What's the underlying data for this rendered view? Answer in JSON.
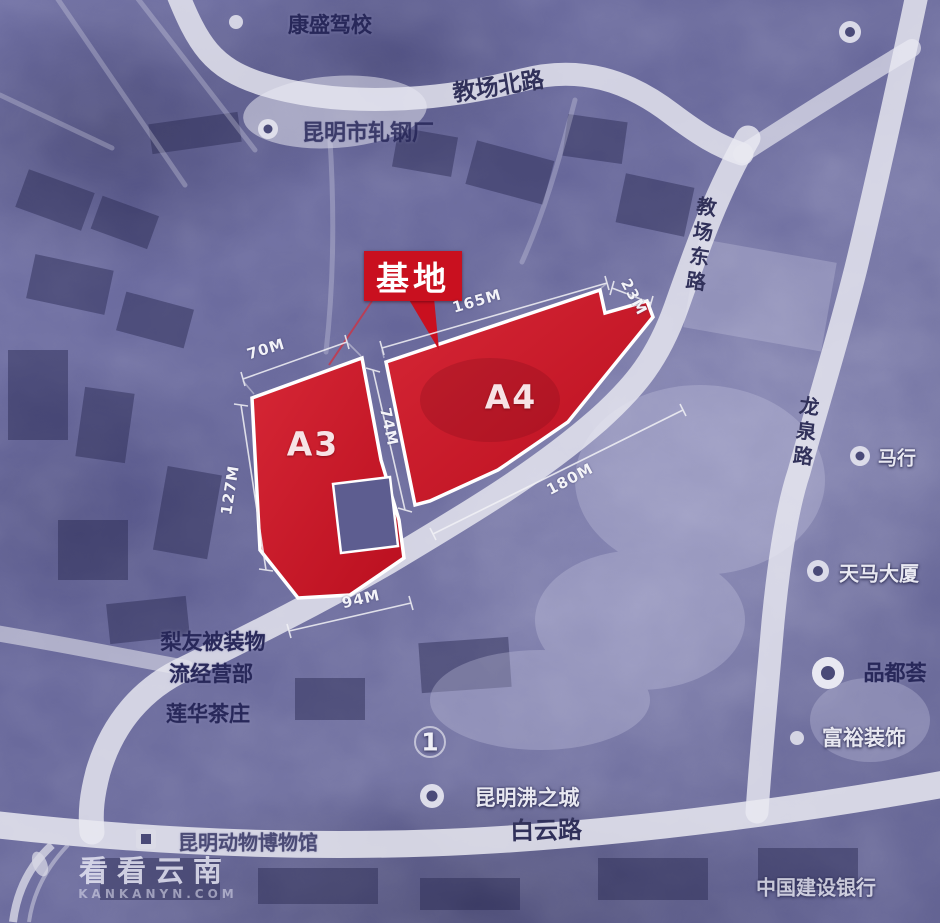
{
  "map": {
    "callout": {
      "label": "基地"
    },
    "parcels": {
      "a3": "A3",
      "a4": "A4"
    },
    "dimensions": {
      "a3_top": "70M",
      "a3_left": "127M",
      "a3_bottom": "94M",
      "gap": "74M",
      "a4_top": "165M",
      "a4_corner": "23M",
      "a4_road": "180M"
    },
    "roads": {
      "jiaochang_north": "教场北路",
      "jiaochang_east": "教场东路",
      "longquan": "龙泉路",
      "baiyun": "白云路"
    },
    "pois": {
      "driving_school": "康盛驾校",
      "steel_mill": "昆明市轧钢厂",
      "bedding_line1": "梨友被装物",
      "bedding_line2": "流经营部",
      "tea_house": "莲华茶庄",
      "museum": "昆明动物博物馆",
      "feizhicheng": "昆明沸之城",
      "ccb_bank": "中国建设银行",
      "tianma_tower": "天马大厦",
      "pinduhui": "品都荟",
      "fuyu_decor": "富裕装饰",
      "mahang": "马行"
    },
    "route_marker": "1"
  },
  "watermark": {
    "brand": "看看云南",
    "domain": "KANKANYN.COM"
  },
  "colors": {
    "parcel_red": "#cd1426",
    "callout_red": "#c9101f",
    "road_white": "#e9e9f1",
    "map_base": "#62629a",
    "dark_label": "#24245a"
  }
}
